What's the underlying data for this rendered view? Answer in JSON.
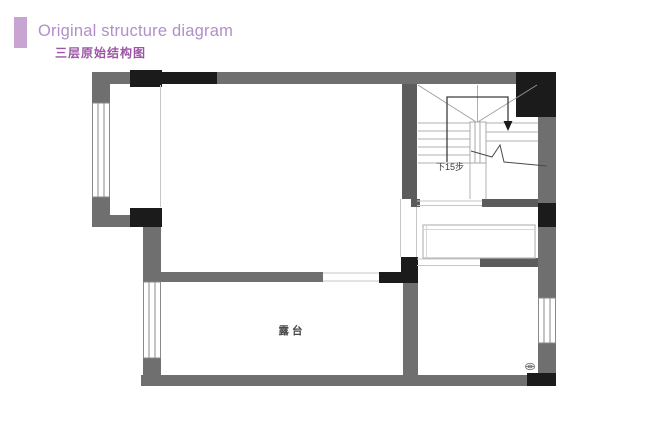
{
  "header": {
    "title": "Original structure diagram",
    "subtitle": "三层原始结构图"
  },
  "plan": {
    "stairs": {
      "direction_label": "下15步"
    },
    "terrace": {
      "label": "露台"
    }
  },
  "colors": {
    "accent_bar": "#c8a4d3",
    "title_text": "#b18fc7",
    "subtitle_text": "#9c55a5",
    "wall": "#6f6f6f",
    "wall_dark": "#5c5c5c",
    "column": "#1b1b1b",
    "thin_line": "#c6c6c6",
    "stair_line": "#b0b0b0",
    "annotation": "#3d3d3d"
  }
}
